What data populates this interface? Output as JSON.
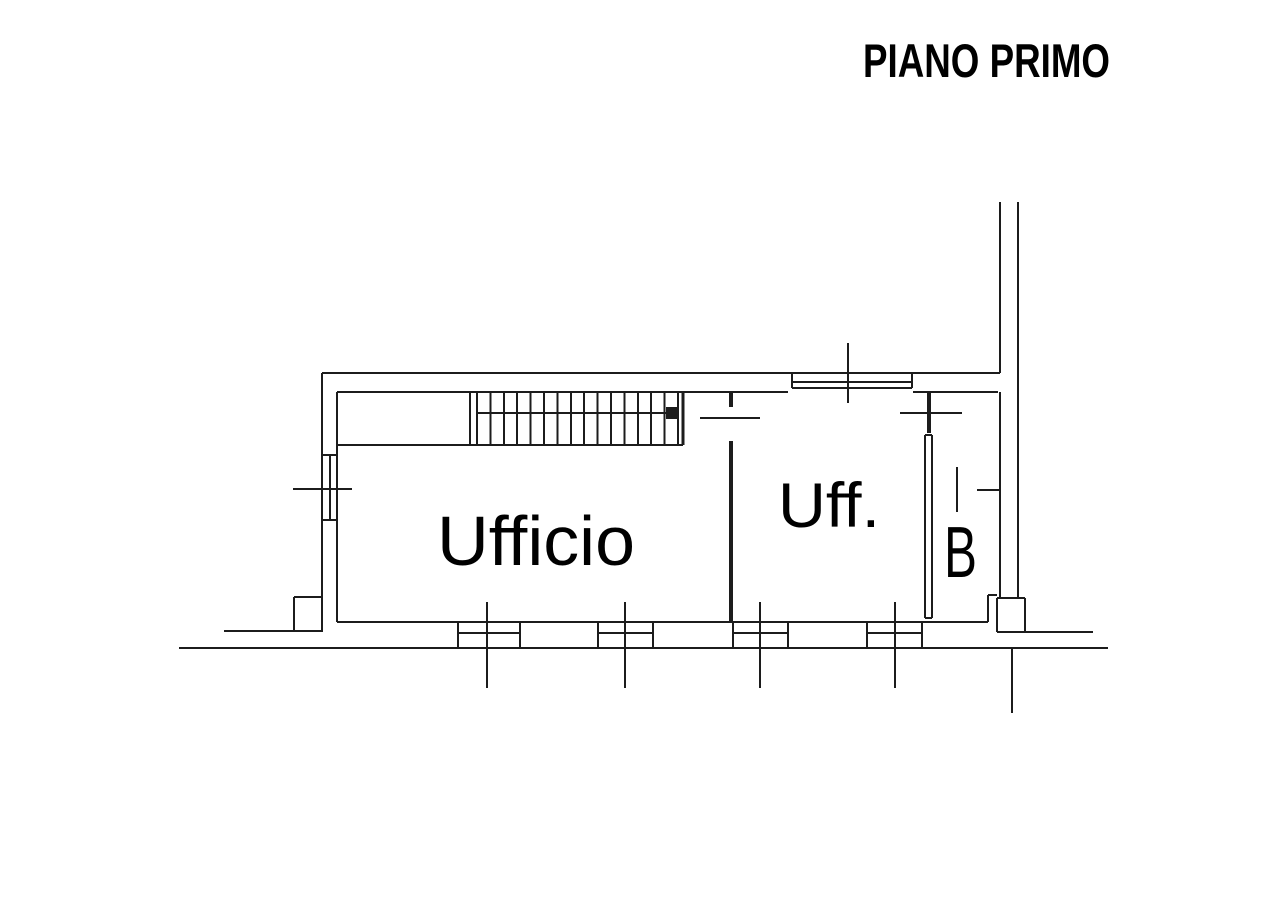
{
  "title": {
    "text": "PIANO PRIMO"
  },
  "floor_plan": {
    "line_color": "#1c1c1c",
    "default_stroke": 2,
    "rooms": [
      {
        "id": "ufficio",
        "label": "Ufficio",
        "x": 437,
        "y": 565,
        "font_size": 70,
        "text_length": 198
      },
      {
        "id": "uff",
        "label": "Uff.",
        "x": 778,
        "y": 527,
        "font_size": 63,
        "text_length": 102
      },
      {
        "id": "b",
        "label": "B",
        "x": 944,
        "y": 577,
        "font_size": 72,
        "text_length": 33
      }
    ],
    "lines": [
      [
        322,
        373,
        1000,
        373
      ],
      [
        322,
        373,
        322,
        632
      ],
      [
        337,
        392,
        788,
        392
      ],
      [
        913,
        392,
        998,
        392
      ],
      [
        337,
        392,
        337,
        622
      ],
      [
        337,
        622,
        988,
        622
      ],
      [
        179,
        648,
        1108,
        648
      ],
      [
        1000,
        202,
        1000,
        373
      ],
      [
        1000,
        392,
        1000,
        598
      ],
      [
        1018,
        202,
        1018,
        598
      ],
      [
        322,
        455,
        337,
        455
      ],
      [
        322,
        520,
        337,
        520
      ],
      [
        330,
        455,
        330,
        520
      ],
      [
        293,
        489,
        352,
        489
      ],
      [
        224,
        631,
        322,
        631
      ],
      [
        294,
        597,
        294,
        631
      ],
      [
        294,
        597,
        322,
        597
      ],
      [
        792,
        382,
        912,
        382
      ],
      [
        792,
        388,
        912,
        388
      ],
      [
        792,
        373,
        792,
        388
      ],
      [
        912,
        373,
        912,
        388
      ],
      [
        848,
        343,
        848,
        403
      ],
      [
        337,
        445,
        683,
        445
      ],
      [
        470,
        392,
        470,
        445
      ],
      [
        477,
        392,
        477,
        445
      ],
      [
        678,
        392,
        678,
        445
      ],
      [
        683,
        392,
        683,
        445,
        3
      ],
      [
        731,
        392,
        731,
        407,
        4
      ],
      [
        731,
        441,
        731,
        622,
        4
      ],
      [
        700,
        418,
        760,
        418
      ],
      [
        929,
        393,
        929,
        433,
        4
      ],
      [
        900,
        413,
        962,
        413
      ],
      [
        925,
        435,
        925,
        618
      ],
      [
        932,
        435,
        932,
        618
      ],
      [
        925,
        435,
        932,
        435
      ],
      [
        925,
        618,
        932,
        618
      ],
      [
        957,
        467,
        957,
        512
      ],
      [
        977,
        490,
        1000,
        490
      ],
      [
        988,
        595,
        988,
        622
      ],
      [
        988,
        595,
        997,
        595
      ],
      [
        997,
        598,
        997,
        632
      ],
      [
        1025,
        598,
        1025,
        632
      ],
      [
        997,
        598,
        1025,
        598
      ],
      [
        997,
        632,
        1025,
        632
      ],
      [
        1025,
        632,
        1093,
        632
      ],
      [
        1012,
        648,
        1012,
        713
      ]
    ],
    "stairs": {
      "left_x": 477,
      "right_x": 678,
      "top_y": 392,
      "bottom_y": 445,
      "tread_count": 14,
      "rail": {
        "x1": 477,
        "x2": 668,
        "y": 413
      },
      "marker": {
        "x": 666,
        "y": 407,
        "size": 12
      }
    },
    "bottom_window_y": {
      "top": 622,
      "bottom": 648,
      "mid": 633,
      "tick_top": 602,
      "tick_bottom": 688
    },
    "bottom_windows": [
      {
        "x1": 458,
        "x2": 520,
        "tick": 487
      },
      {
        "x1": 598,
        "x2": 653,
        "tick": 625
      },
      {
        "x1": 733,
        "x2": 788,
        "tick": 760
      },
      {
        "x1": 867,
        "x2": 922,
        "tick": 895
      }
    ]
  }
}
